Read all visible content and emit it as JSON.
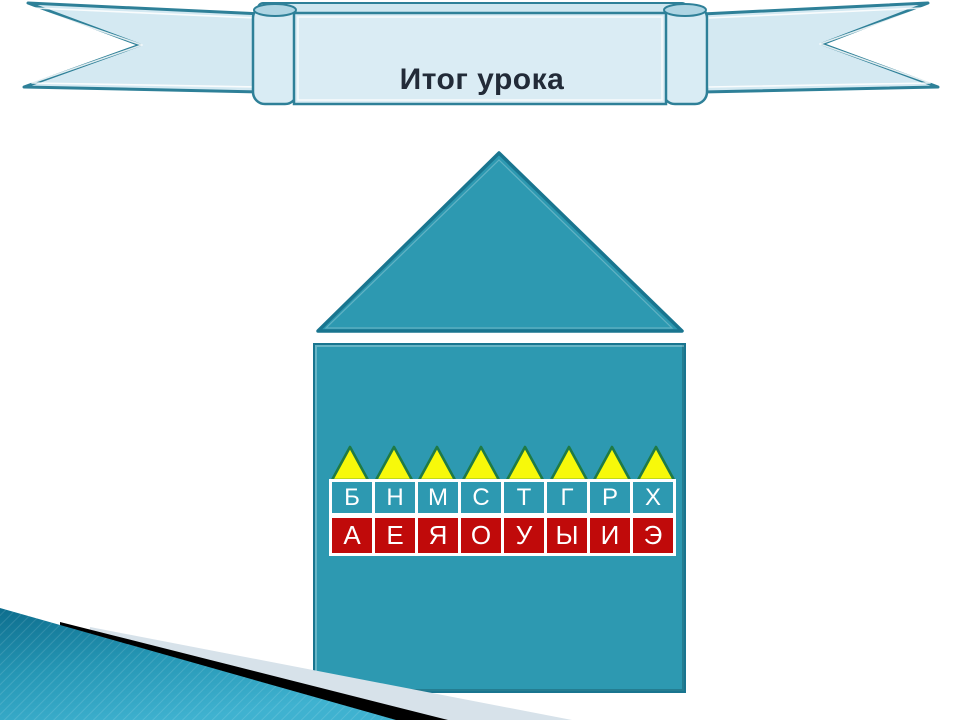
{
  "banner": {
    "title": "Итог урока"
  },
  "house": {
    "triangle_count": 8,
    "consonants": [
      "Б",
      "Н",
      "М",
      "С",
      "Т",
      "Г",
      "Р",
      "Х"
    ],
    "vowels": [
      "А",
      "Е",
      "Я",
      "О",
      "У",
      "Ы",
      "И",
      "Э"
    ]
  },
  "colors": {
    "house_teal": "#2d99b1",
    "house_border": "#19758f",
    "banner_fill": "#daecf4",
    "banner_flap_fill": "#cfe7f0",
    "banner_border": "#2e8098",
    "title_text": "#222b38",
    "triangle_fill": "#f7f90a",
    "triangle_border": "#1f7a45",
    "vowel_red": "#c00a0a",
    "letter_white": "#ffffff",
    "corner_gray": "#d7e2ea",
    "corner_black": "#000000",
    "corner_teal_dark": "#0d6d8d",
    "corner_teal_mid": "#2596b4",
    "corner_teal_light": "#3fb2d0"
  }
}
